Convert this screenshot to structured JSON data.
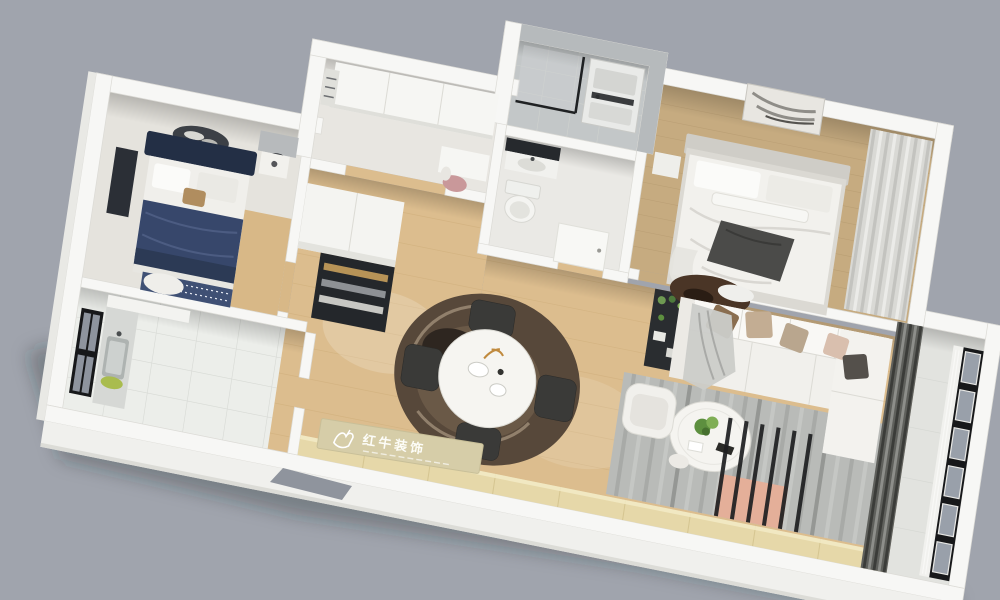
{
  "watermark": {
    "text": "红牛装饰",
    "logo_icon": "bull-logo-icon"
  },
  "colors": {
    "background": "#a0a4ad",
    "wall": "#f7f7f5",
    "facade": "#f0f0ed",
    "wood_floor": "#dcbd8e",
    "master_floor": "#c6ab80",
    "laundry_tile": "#c3c7c8",
    "laundry_wall": "#b6babc",
    "balcony_floor": "#e2e3df",
    "living_rug": "#b9bbb8",
    "living_rug_stripe": "#a6a8a5",
    "salmon_rug": "#e4af99",
    "sofa": "#f1f0ec",
    "pillow_brown": "#8a6e50",
    "pillow_tan": "#c3ad93",
    "dining_rug_outer": "#57483a",
    "dining_rug_inner": "#6d5b49",
    "dining_rug_dark": "#2e2620",
    "navy_duvet": "#37476b",
    "navy_headboard": "#232f45",
    "console_wood": "#e6d8a9",
    "window_frame": "#17181a",
    "glass": "#99a0aa",
    "plant_green": "#5d8f3f",
    "plaque": "#d6cda8",
    "plaque_text": "#fdfdf8"
  }
}
